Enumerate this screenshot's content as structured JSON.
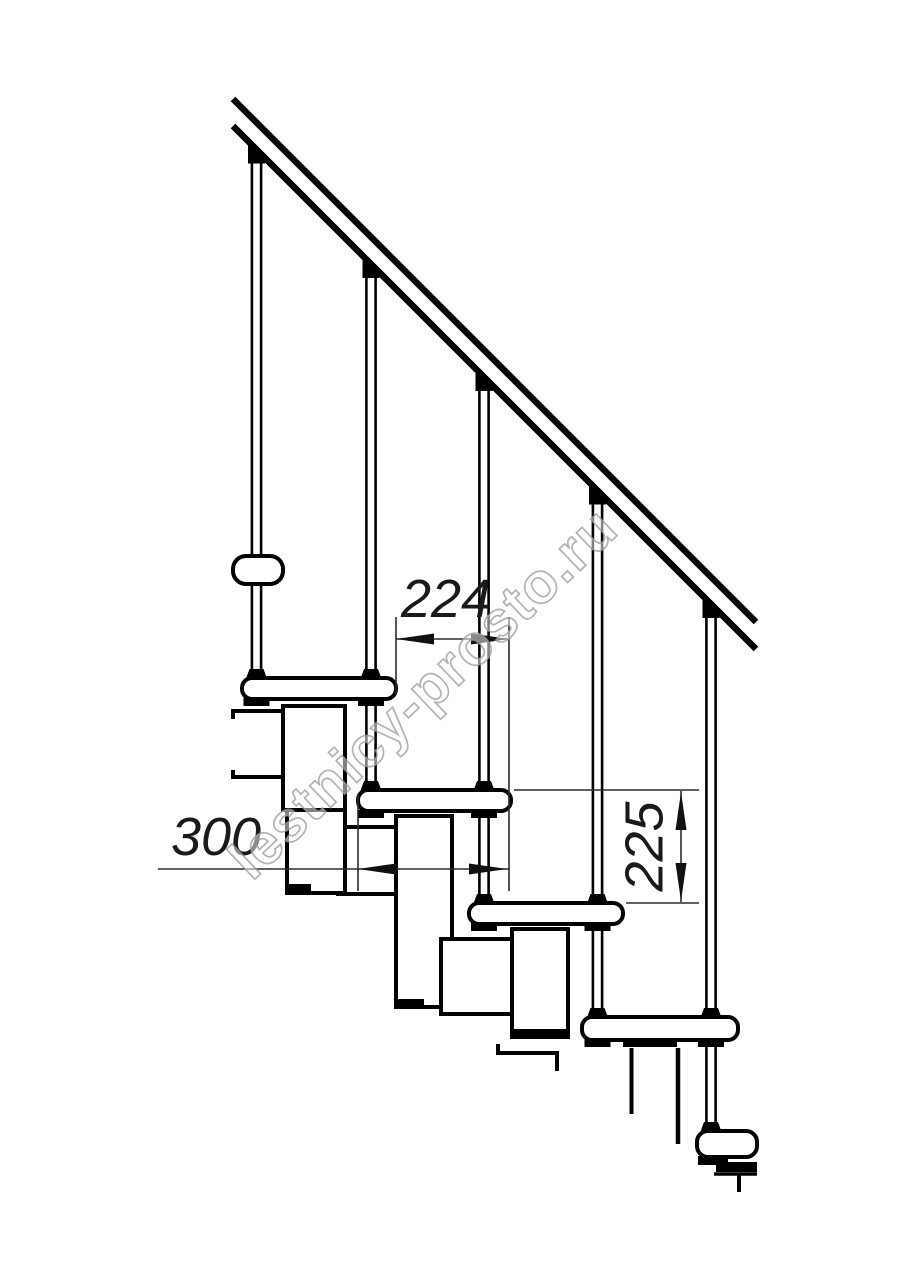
{
  "canvas": {
    "background": "#ffffff"
  },
  "drawing": {
    "type": "modular-staircase-side-elevation",
    "dimensions": [
      {
        "id": "step-run",
        "value": "224",
        "orientation": "horizontal"
      },
      {
        "id": "tread-depth",
        "value": "300",
        "orientation": "horizontal"
      },
      {
        "id": "step-rise",
        "value": "225",
        "orientation": "vertical"
      }
    ],
    "watermark": "lestnicy-prosto.ru",
    "colors": {
      "line": "#000000",
      "dimension_line": "#2b2b2b",
      "dimension_text": "#1a1a1a",
      "watermark_stroke": "#999999"
    }
  }
}
